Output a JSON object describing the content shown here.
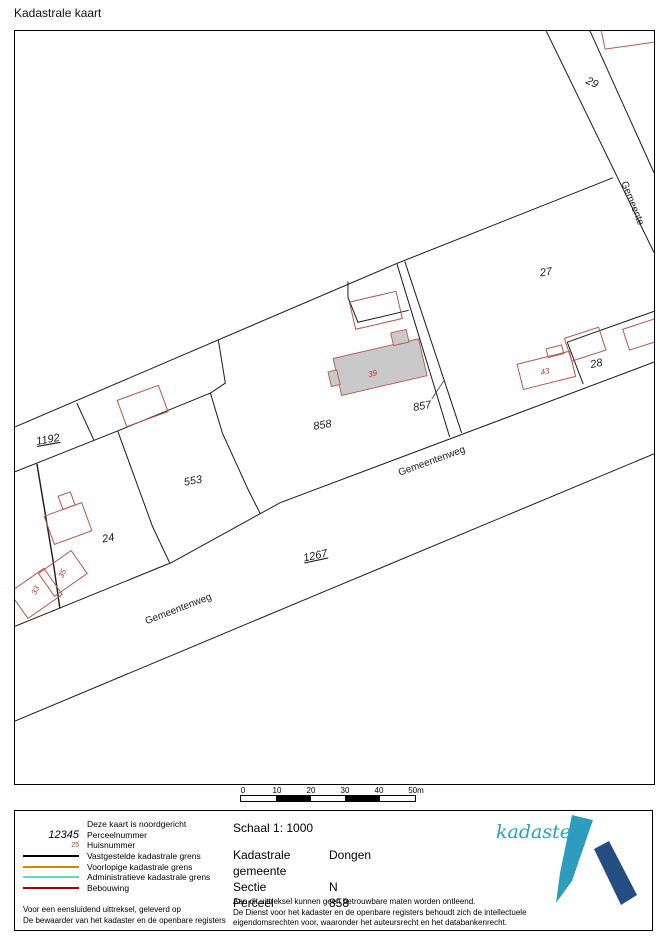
{
  "page": {
    "title": "Kadastrale kaart"
  },
  "map": {
    "parcel_labels": [
      {
        "text": "29"
      },
      {
        "text": "27"
      },
      {
        "text": "28"
      },
      {
        "text": "857"
      },
      {
        "text": "858"
      },
      {
        "text": "553"
      },
      {
        "text": "1192"
      },
      {
        "text": "24"
      },
      {
        "text": "1267"
      }
    ],
    "house_numbers": [
      {
        "text": "39"
      },
      {
        "text": "43"
      },
      {
        "text": "35"
      },
      {
        "text": "33"
      }
    ],
    "road_labels": [
      {
        "text": "Gemeentenweg"
      },
      {
        "text": "Gemeentenweg"
      },
      {
        "text": "Gemeente"
      }
    ]
  },
  "scalebar": {
    "ticks": [
      "0",
      "10",
      "20",
      "30",
      "40",
      "50m"
    ],
    "segment_colors": [
      "#ffffff",
      "#000000",
      "#ffffff",
      "#000000",
      "#ffffff"
    ]
  },
  "legend": {
    "north_note": "Deze kaart is noordgericht",
    "items": [
      {
        "symbol": "12345",
        "label": "Perceelnummer"
      },
      {
        "symbol": "25",
        "label": "Huisnummer"
      },
      {
        "color": "#000000",
        "label": "Vastgestelde kadastrale grens"
      },
      {
        "color": "#cc8a00",
        "label": "Voorlopige kadastrale grens"
      },
      {
        "color": "#63d6c4",
        "label": "Administratieve kadastrale grens"
      },
      {
        "color": "#a00000",
        "label": "Bebouwing"
      }
    ],
    "footer_lines": [
      "Voor een eensluidend uittreksel, geleverd op",
      "De bewaarder van het kadaster en de openbare registers"
    ]
  },
  "info": {
    "schaal": "Schaal 1: 1000",
    "fields": [
      {
        "label": "Kadastrale gemeente",
        "value": "Dongen"
      },
      {
        "label": "Sectie",
        "value": "N"
      },
      {
        "label": "Perceel",
        "value": "858"
      }
    ],
    "disclaimer_lines": [
      "Aan dit uittreksel kunnen geen betrouwbare maten worden ontleend.",
      "De Dienst voor het kadaster en de openbare registers behoudt zich de intellectuele",
      "eigendomsrechten voor, waaronder het auteursrecht en het databankenrecht."
    ]
  },
  "logo": {
    "text": "kadaster",
    "light_blue": "#2e9dbd",
    "dark_blue": "#244e82"
  },
  "colors": {
    "parcel_line": "#1a1a1a",
    "building_outline": "#b5564d",
    "building_fill": "#c9c9c9",
    "house_number": "#b03a30"
  }
}
